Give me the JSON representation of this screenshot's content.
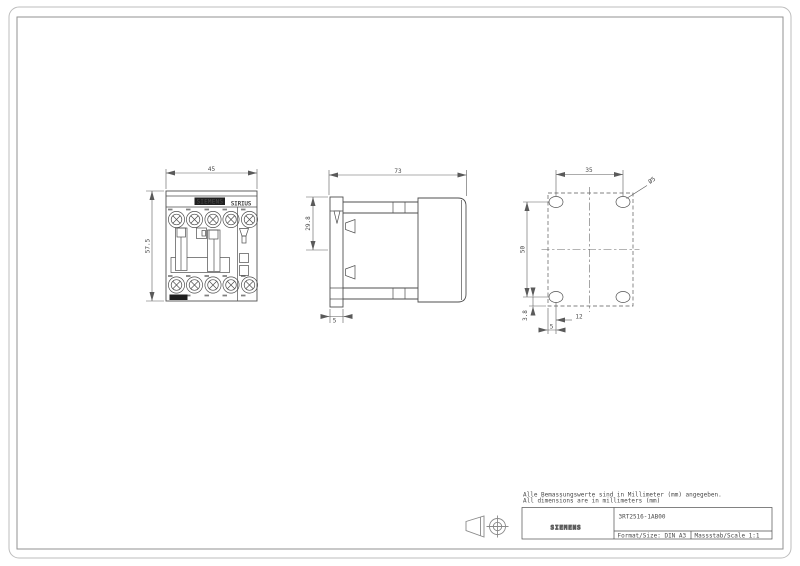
{
  "colors": {
    "line": "#4f4f4f",
    "border_outer": "#bdbdbd",
    "border_inner": "#929292",
    "label_fill": "#1f1f1f",
    "background": "#ffffff"
  },
  "front_view": {
    "brand": "SIEMENS",
    "series": "SIRIUS",
    "dim_width": "45",
    "dim_height": "57.5"
  },
  "side_view": {
    "dim_depth": "73",
    "dim_clip": "29.8",
    "dim_foot": "5"
  },
  "mounting_view": {
    "dim_hole_spacing_h": "35",
    "dim_hole_spacing_v": "50",
    "dim_edge_v": "3.8",
    "dim_edge_h": "12",
    "dim_offset": "5",
    "hole_label": "Ø5"
  },
  "notes": {
    "de": "Alle Bemassungswerte sind in Millimeter (mm) angegeben.",
    "en": "All dimensions are in millimeters (mm)"
  },
  "title_block": {
    "logo": "SIEMENS",
    "part_number": "3RT2516-1AB00",
    "format_label": "Format/Size: DIN A3",
    "scale_label": "Massstab/Scale 1:1"
  }
}
